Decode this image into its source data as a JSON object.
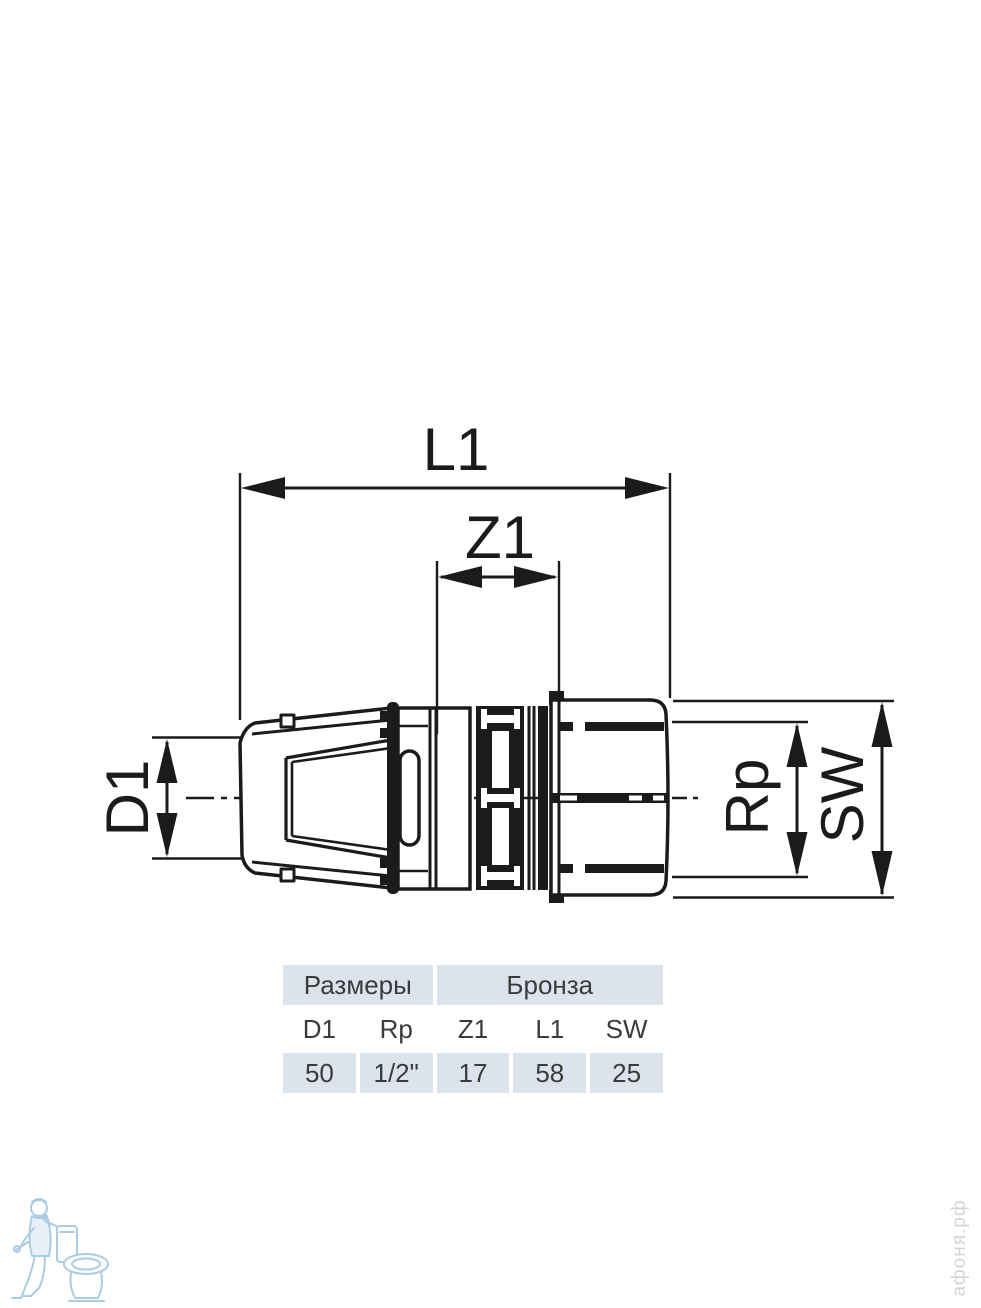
{
  "page": {
    "background": "#ffffff"
  },
  "diagram": {
    "line_color": "#1b1b1b",
    "dimension_labels": {
      "l1": "L1",
      "z1": "Z1",
      "d1": "D1",
      "rp": "Rp",
      "sw": "SW"
    }
  },
  "table": {
    "group_headers": [
      {
        "label": "Размеры",
        "colspan": 2
      },
      {
        "label": "Бронза",
        "colspan": 3
      }
    ],
    "columns": [
      "D1",
      "Rp",
      "Z1",
      "L1",
      "SW"
    ],
    "values": [
      "50",
      "1/2\"",
      "17",
      "58",
      "25"
    ],
    "shaded_bg": "#dde3ed",
    "text_color": "#3b3b3b"
  },
  "watermarks": {
    "site": "афоня.рф",
    "site_color": "#d4d4d4",
    "icon": "plumber-with-toilet-icon",
    "icon_color": "#a3c6e1"
  }
}
